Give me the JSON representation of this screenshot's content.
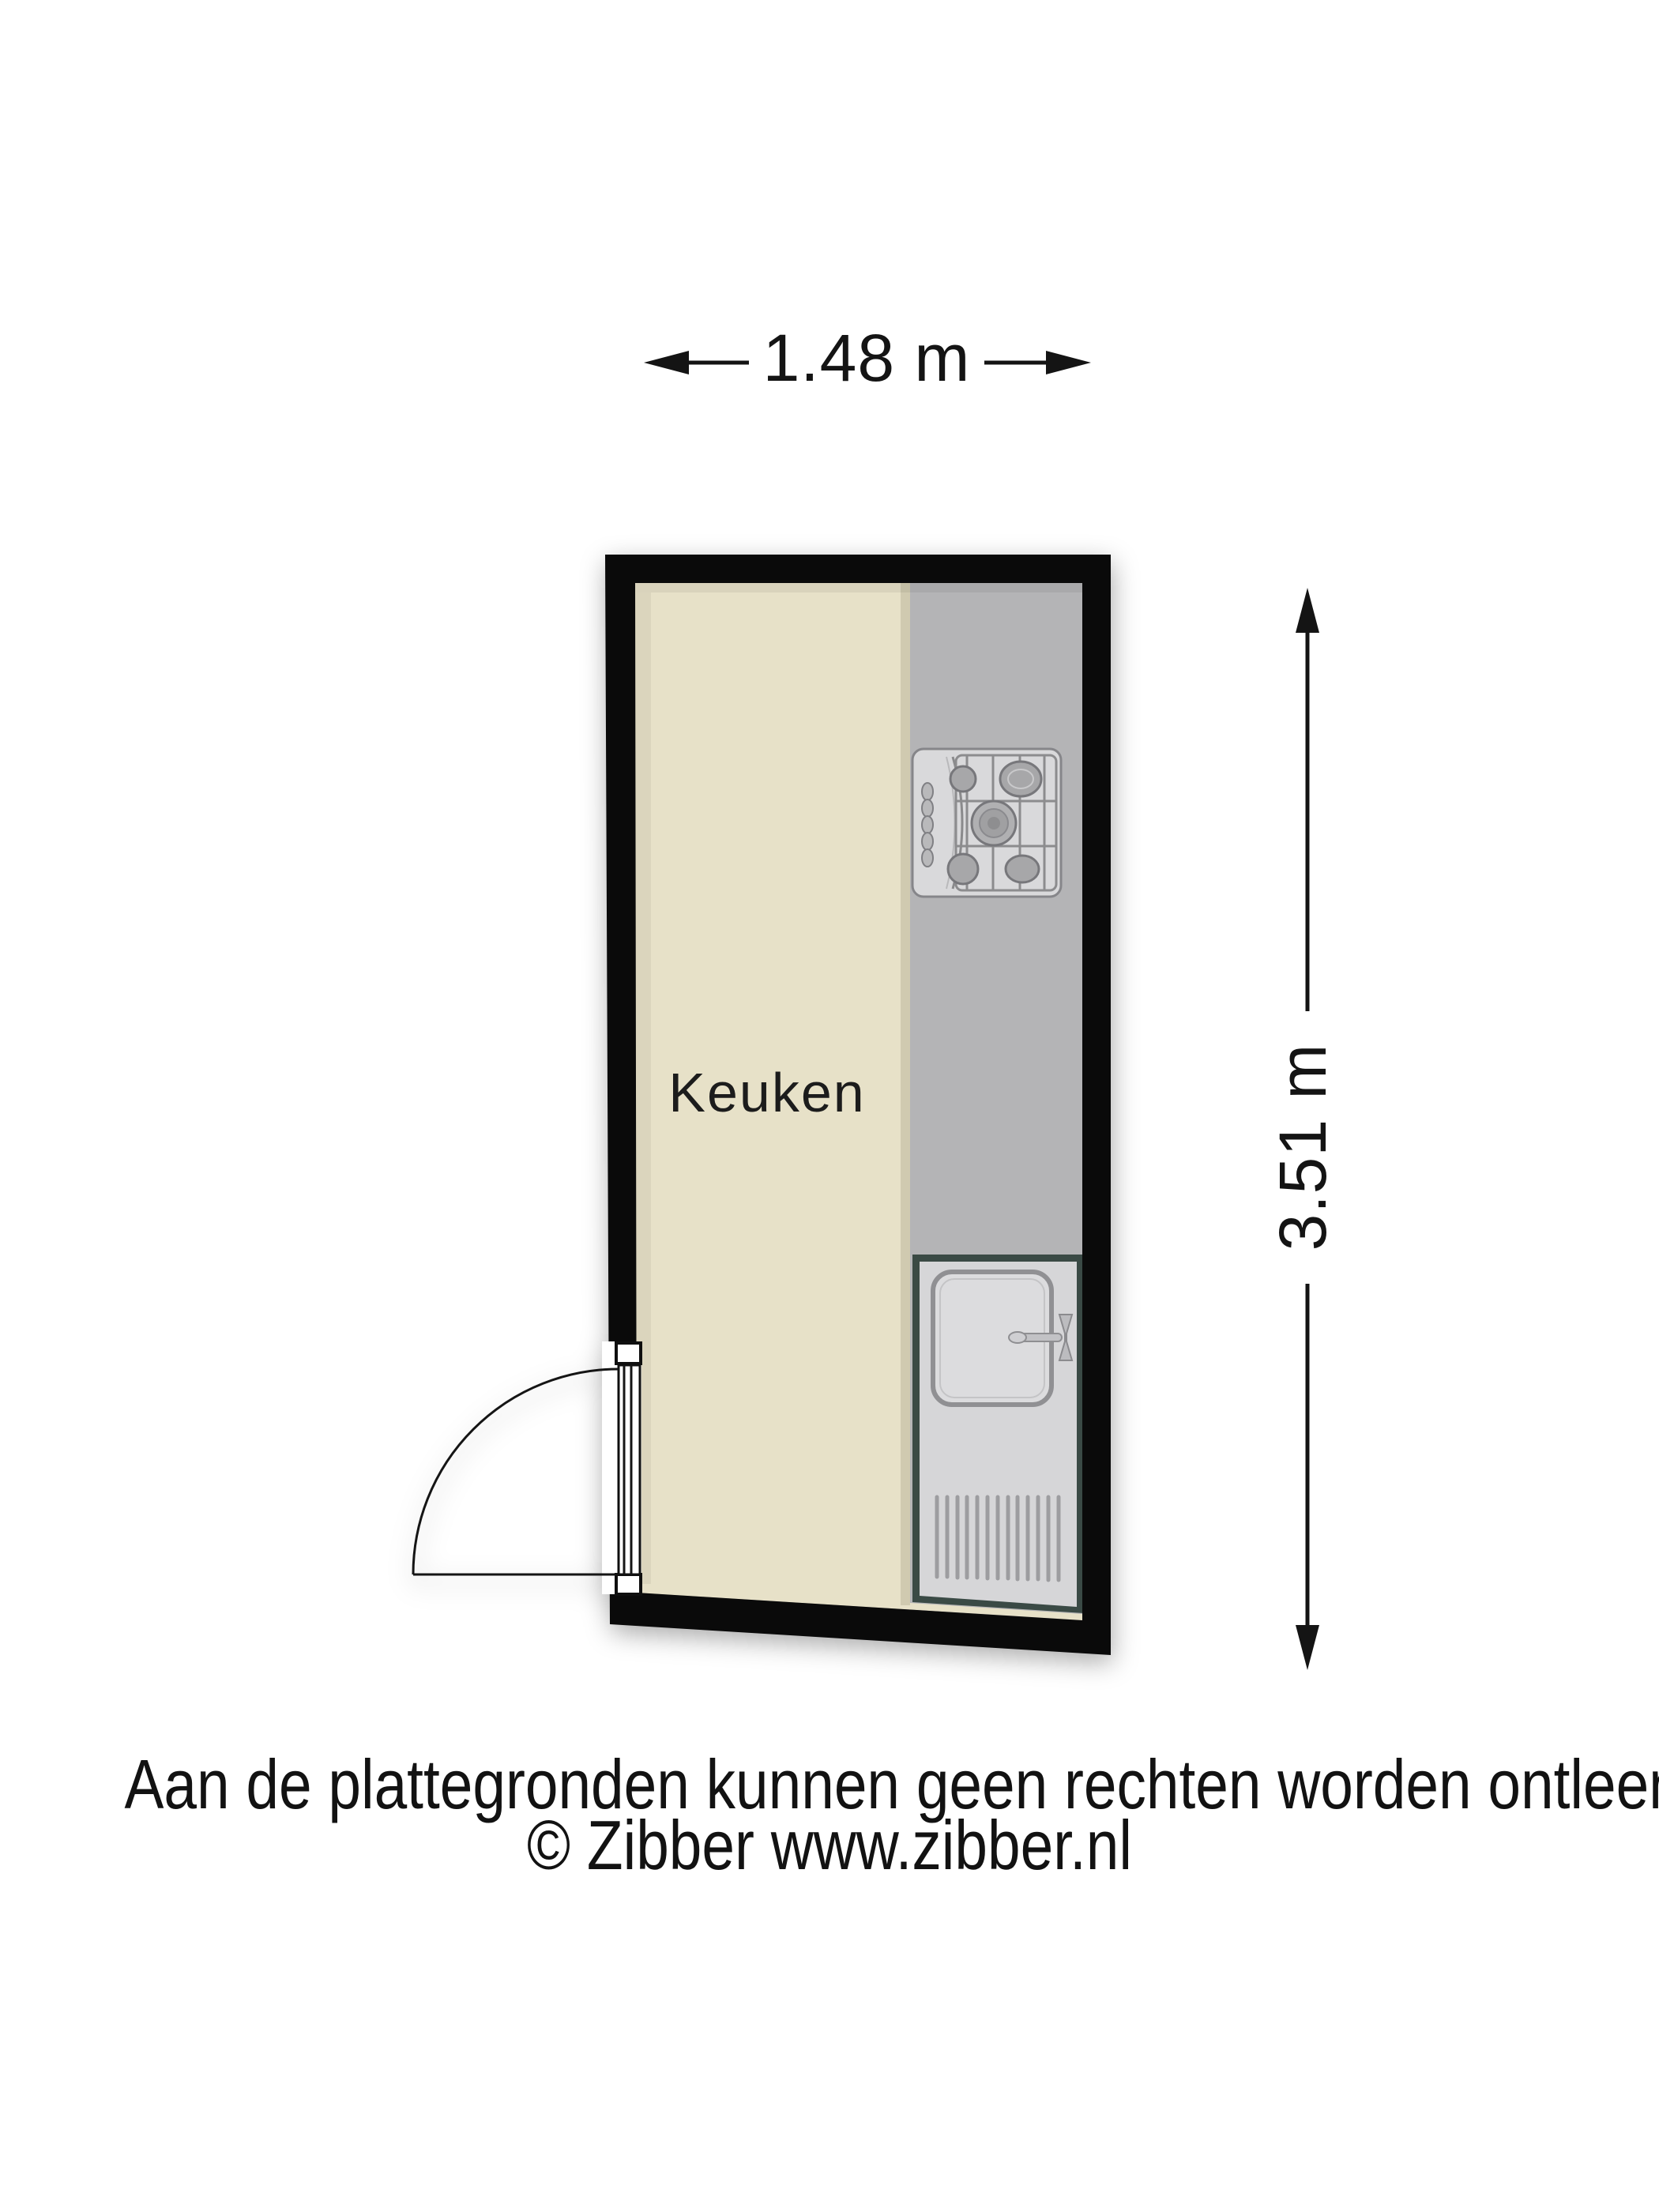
{
  "floorplan": {
    "room_label": "Keuken",
    "width_label": "1.48 m",
    "height_label": "3.51 m",
    "fixtures": {
      "stove": "gas-hob-icon",
      "sink": "sink-icon",
      "door": "door-swing-icon"
    }
  },
  "footer": {
    "disclaimer": "Aan de plattegronden kunnen geen rechten worden ontleend",
    "copyright": "© Zibber www.zibber.nl"
  },
  "colors": {
    "background": "#ffffff",
    "wall": "#0a0a0a",
    "floor": "#e7e1c8",
    "floor_shadow": "#d8d2b9",
    "counter": "#b4b4b6",
    "fixture_frame": "#3a4a45",
    "fixture_fill": "#d6d6d8",
    "line": "#151515",
    "text": "#141414"
  }
}
